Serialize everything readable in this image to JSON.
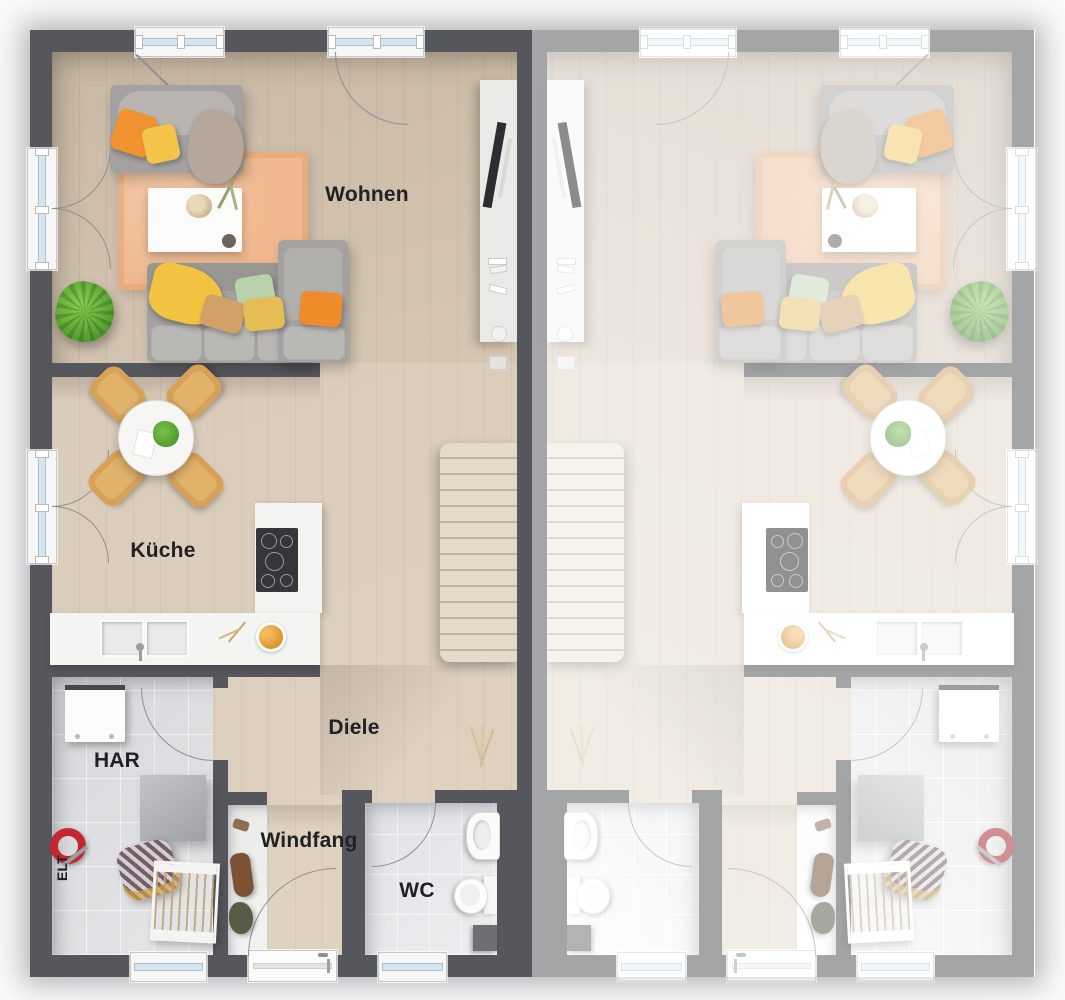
{
  "floorplan": {
    "kind": "ground-floor-plan-semi-detached-duplex",
    "units": {
      "left": {
        "name": "unit-left",
        "style": "active-unit"
      },
      "right": {
        "name": "unit-right",
        "style": "faded-mirrored-copy"
      }
    },
    "rooms": {
      "wohnen": {
        "label": "Wohnen"
      },
      "kueche": {
        "label": "Küche"
      },
      "diele": {
        "label": "Diele"
      },
      "windfang": {
        "label": "Windfang"
      },
      "wc": {
        "label": "WC"
      },
      "har": {
        "label": "HAR"
      },
      "elt": {
        "label": "ELT"
      }
    },
    "colors": {
      "wall": "#55575c",
      "floor_wood_living": "#cdbda9",
      "floor_wood_hall": "#dccdbb",
      "floor_tile": "#dcdde0",
      "window_glass": "#d5e6f0",
      "rug": "#efb88e",
      "accent_orange": "#f0922f",
      "accent_yellow": "#f3c34a",
      "accent_green": "#bad2ab",
      "plant_green": "#6db73e",
      "chair_wood": "#d7a258",
      "vacuum_red": "#c4242b"
    }
  }
}
